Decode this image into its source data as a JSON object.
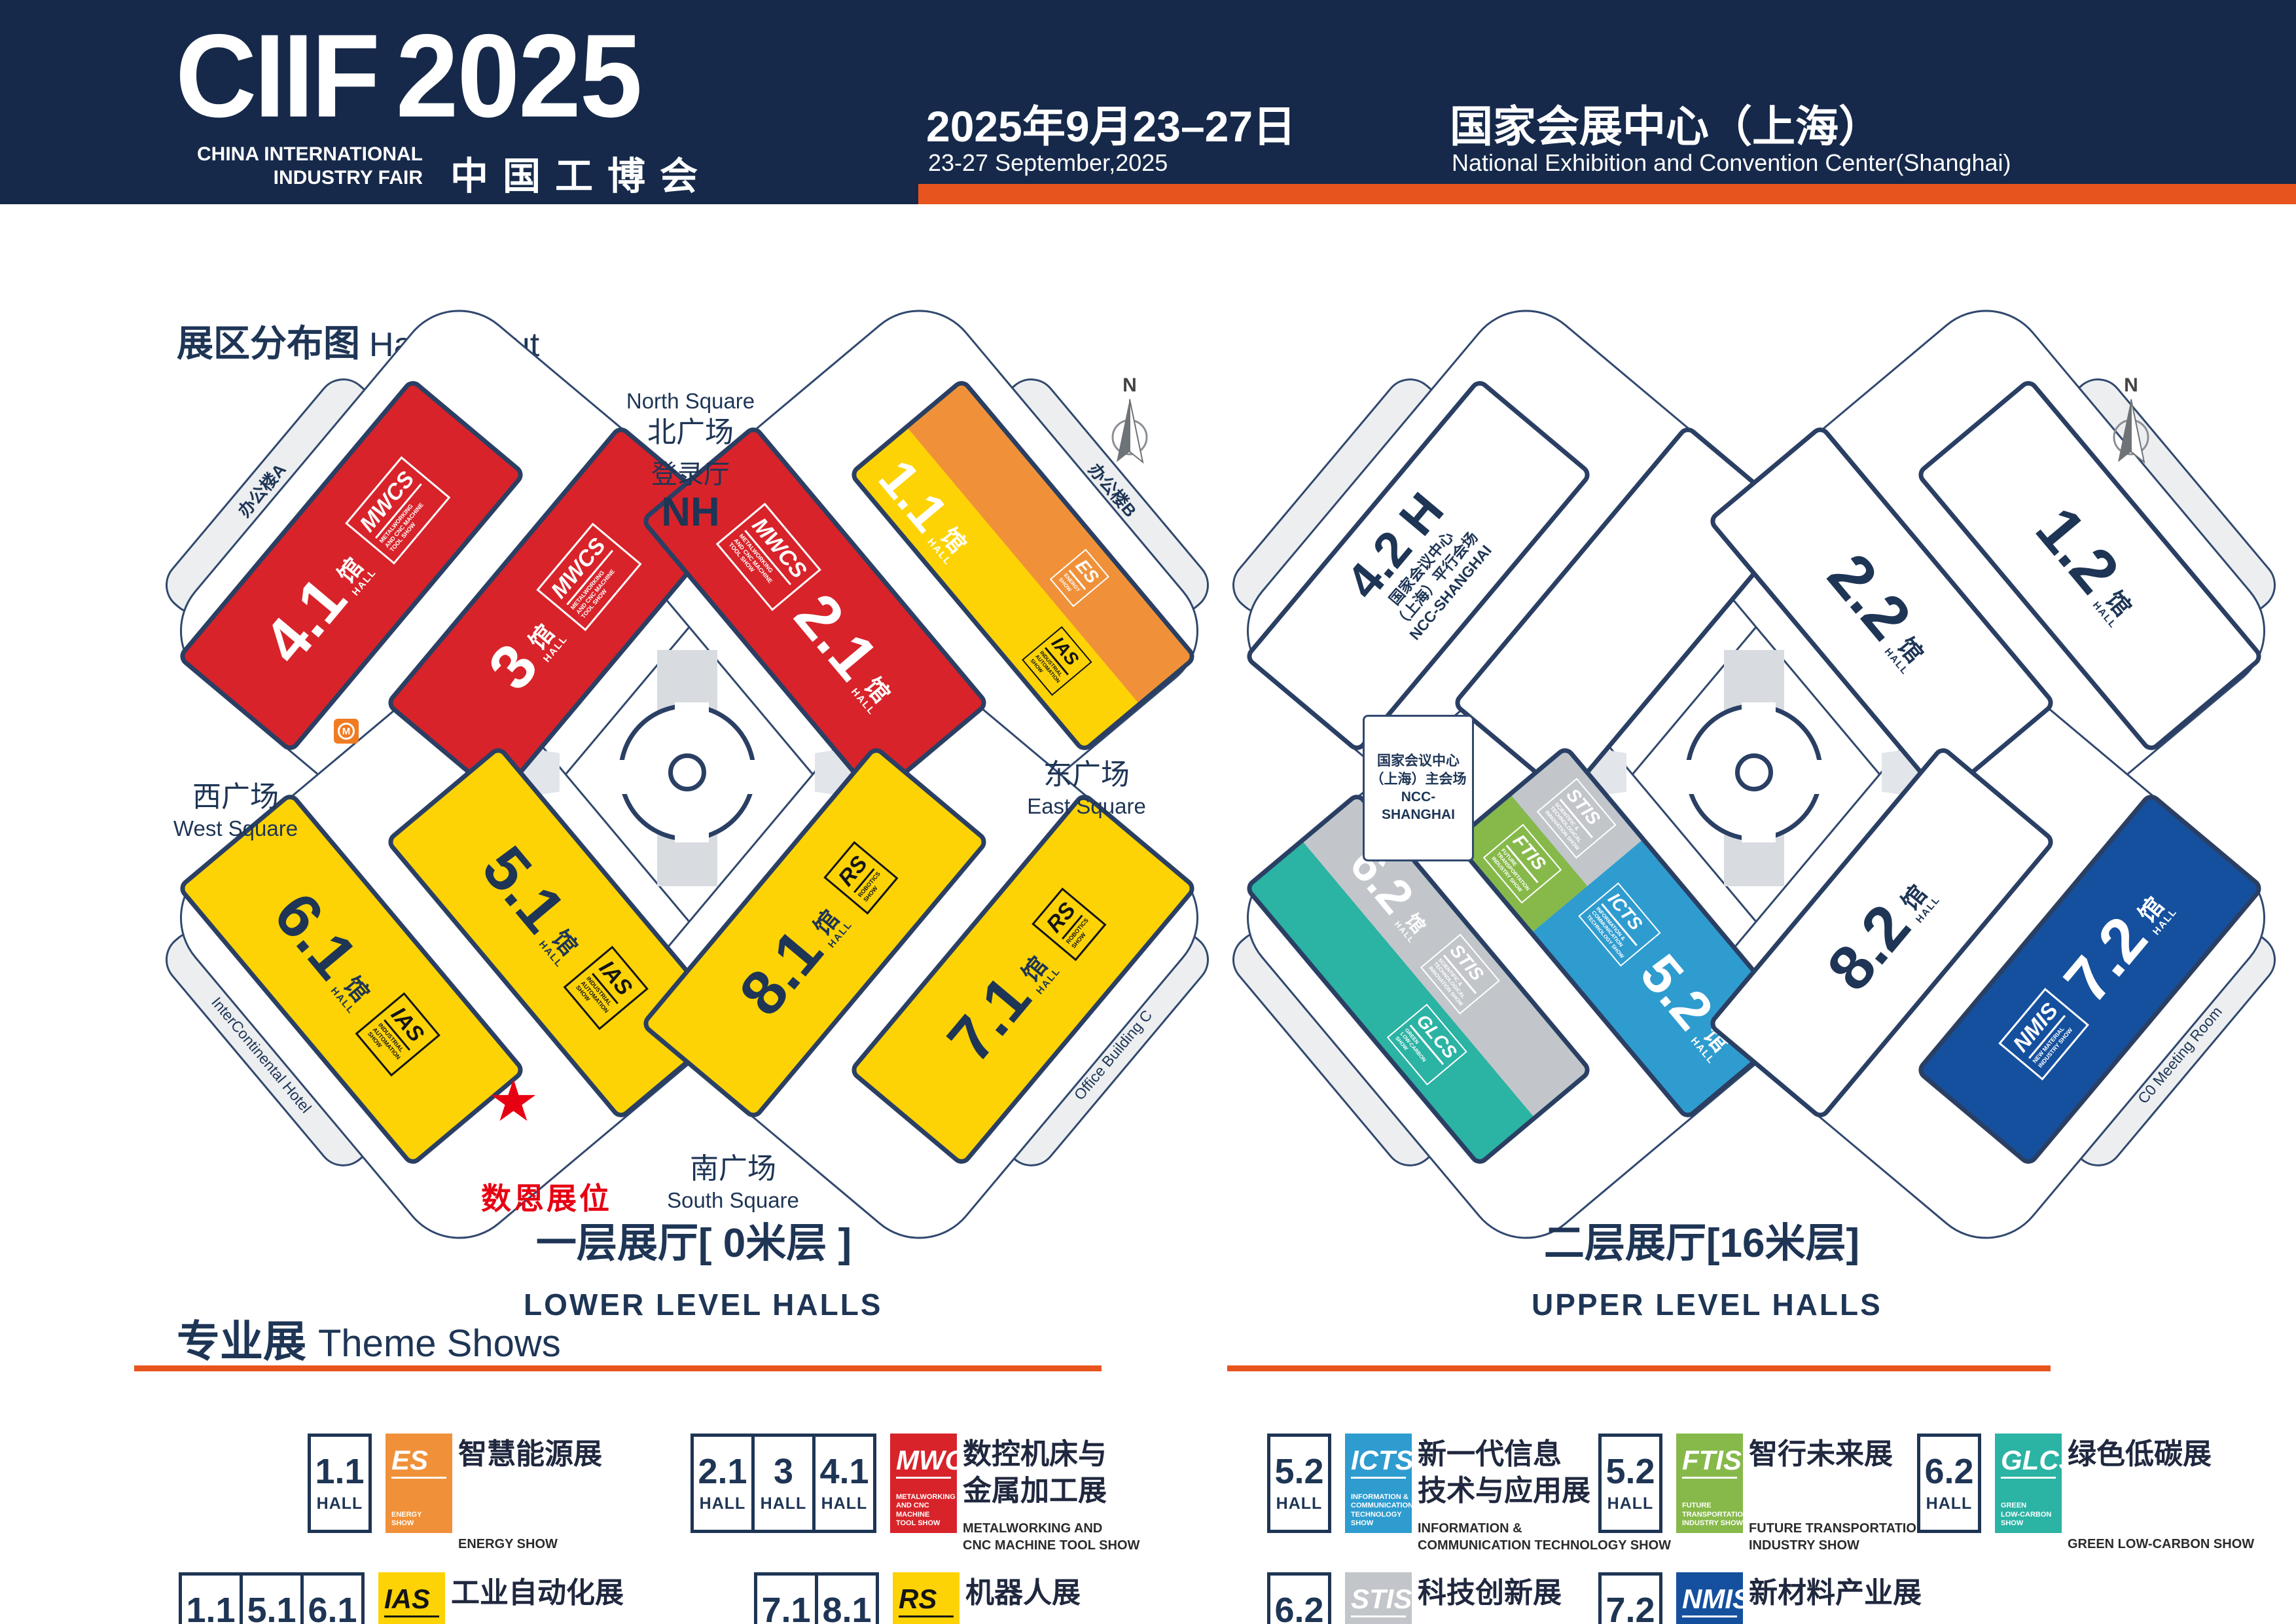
{
  "common": {
    "guan": "馆",
    "hall_word": "HALL"
  },
  "header": {
    "logo_main": "CIIF",
    "logo_year": "2025",
    "logo_en1": "CHINA INTERNATIONAL",
    "logo_en2": "INDUSTRY FAIR",
    "logo_cn": "中国工博会",
    "date_cn": "2025年9月23–27日",
    "date_en": "23-27 September,2025",
    "venue_cn": "国家会展中心（上海）",
    "venue_en": "National Exhibition and Convention Center(Shanghai)"
  },
  "section": {
    "cn": "展区分布图",
    "en": "Hall Layout"
  },
  "logos": {
    "MWCS": {
      "abbr": "MWCS",
      "lines": [
        "METALWORKING",
        "AND CNC MACHINE",
        "TOOL SHOW"
      ],
      "bg": "#d8232a",
      "fg": "#ffffff"
    },
    "IAS": {
      "abbr": "IAS",
      "lines": [
        "INDUSTRIAL",
        "AUTOMATION",
        "SHOW"
      ],
      "bg": "#fdd305",
      "fg": "#141414"
    },
    "ES": {
      "abbr": "ES",
      "lines": [
        "ENERGY",
        "SHOW"
      ],
      "bg": "#f0913a",
      "fg": "#ffffff"
    },
    "RS": {
      "abbr": "RS",
      "lines": [
        "ROBOTICS",
        "SHOW"
      ],
      "bg": "#fdd305",
      "fg": "#141414"
    },
    "ICTS": {
      "abbr": "ICTS",
      "lines": [
        "INFORMATION &",
        "COMMUNICATION",
        "TECHNOLOGY SHOW"
      ],
      "bg": "#2f9cd0",
      "fg": "#ffffff"
    },
    "FTIS": {
      "abbr": "FTIS",
      "lines": [
        "FUTURE",
        "TRANSPORTATION",
        "INDUSTRY SHOW"
      ],
      "bg": "#87b94a",
      "fg": "#ffffff"
    },
    "STIS": {
      "abbr": "STIS",
      "lines": [
        "SCIENTIFIC &",
        "TECHNOLOGICAL",
        "INNOVATION SHOW"
      ],
      "bg": "#c2c6ca",
      "fg": "#ffffff"
    },
    "GLCS": {
      "abbr": "GLCS",
      "lines": [
        "GREEN",
        "LOW-CARBON",
        "SHOW"
      ],
      "bg": "#2bb3a4",
      "fg": "#ffffff"
    },
    "NMIS": {
      "abbr": "NMIS",
      "lines": [
        "NEW MATERIAL",
        "INDUSTRY SHOW"
      ],
      "bg": "#15509e",
      "fg": "#ffffff"
    }
  },
  "lower_map": {
    "labels": {
      "north_en": "North Square",
      "north_cn": "北广场",
      "login_cn": "登录厅",
      "login_code": "NH",
      "west_cn": "西广场",
      "west_en": "West Square",
      "east_cn": "东广场",
      "east_en": "East Square",
      "south_cn": "南广场",
      "south_en": "South Square",
      "booth": "数恩展位",
      "star": "★",
      "metro": "M"
    },
    "buildings": {
      "a_cn": "办公楼A",
      "a_en": "Office Building A",
      "b_cn": "办公楼B",
      "b_en": "Office Building B",
      "c_cn": "办公楼C",
      "c_en": "Office Building C",
      "hotel_cn": "洲际酒店",
      "hotel_en": "InterContinental Hotel"
    },
    "halls": {
      "h3": {
        "num": "3"
      },
      "h41": {
        "num": "4.1"
      },
      "h21": {
        "num": "2.1"
      },
      "h11": {
        "num": "1.1"
      },
      "h51": {
        "num": "5.1"
      },
      "h61": {
        "num": "6.1"
      },
      "h81": {
        "num": "8.1"
      },
      "h71": {
        "num": "7.1"
      }
    }
  },
  "upper_map": {
    "halls": {
      "h42": {
        "num": "4.2 H",
        "sub": [
          "国家会议中心",
          "（上海）平行会场",
          "NCC-SHANGHAI"
        ]
      },
      "h22": {
        "num": "2.2"
      },
      "h12": {
        "num": "1.2"
      },
      "h52": {
        "num": "5.2"
      },
      "h62": {
        "num": "6.2"
      },
      "h82": {
        "num": "8.2"
      },
      "h72": {
        "num": "7.2"
      }
    },
    "ncc": [
      "国家会议中心",
      "（上海）主会场",
      "NCC-SHANGHAI"
    ],
    "co_cn": "C0会议室（3楼）",
    "co_en": "C0 Meeting Room"
  },
  "captions": {
    "lower_cn": "一层展厅[ 0米层 ]",
    "lower_en": "LOWER LEVEL HALLS",
    "upper_cn": "二层展厅[16米层]",
    "upper_en": "UPPER LEVEL HALLS"
  },
  "shows": {
    "title_cn": "专业展",
    "title_en": "Theme Shows",
    "hall_word": "HALL",
    "items": [
      {
        "id": "es",
        "halls": [
          "1.1"
        ],
        "logo": "ES",
        "cn": [
          "智慧能源展"
        ],
        "en": [
          "ENERGY SHOW"
        ]
      },
      {
        "id": "ias",
        "halls": [
          "1.1",
          "5.1",
          "6.1"
        ],
        "logo": "IAS",
        "cn": [
          "工业自动化展"
        ],
        "en": [
          "INDUSTRIAL AUTOMATION SHOW"
        ]
      },
      {
        "id": "mwcs",
        "halls": [
          "2.1",
          "3",
          "4.1"
        ],
        "logo": "MWCS",
        "cn": [
          "数控机床与",
          "金属加工展"
        ],
        "en": [
          "METALWORKING AND",
          "CNC MACHINE TOOL SHOW"
        ]
      },
      {
        "id": "rs",
        "halls": [
          "7.1",
          "8.1"
        ],
        "logo": "RS",
        "cn": [
          "机器人展"
        ],
        "en": [
          "ROBOTICS SHOW"
        ]
      },
      {
        "id": "icts",
        "halls": [
          "5.2"
        ],
        "logo": "ICTS",
        "cn": [
          "新一代信息",
          "技术与应用展"
        ],
        "en": [
          "INFORMATION &",
          "COMMUNICATION TECHNOLOGY SHOW"
        ]
      },
      {
        "id": "ftis",
        "halls": [
          "5.2"
        ],
        "logo": "FTIS",
        "cn": [
          "智行未来展"
        ],
        "en": [
          "FUTURE TRANSPORTATION",
          "INDUSTRY SHOW"
        ]
      },
      {
        "id": "glcs",
        "halls": [
          "6.2"
        ],
        "logo": "GLCS",
        "cn": [
          "绿色低碳展"
        ],
        "en": [
          "GREEN LOW-CARBON SHOW"
        ]
      },
      {
        "id": "stis",
        "halls": [
          "6.2"
        ],
        "logo": "STIS",
        "cn": [
          "科技创新展"
        ],
        "en": [
          "SCIENTIFIC & TECHNOLOGICAL",
          "INNOVATION SHOW"
        ]
      },
      {
        "id": "nmis",
        "halls": [
          "7.2"
        ],
        "logo": "NMIS",
        "cn": [
          "新材料产业展"
        ],
        "en": [
          "NEW MATERIAL INDUSTRY SHOW"
        ]
      }
    ]
  }
}
